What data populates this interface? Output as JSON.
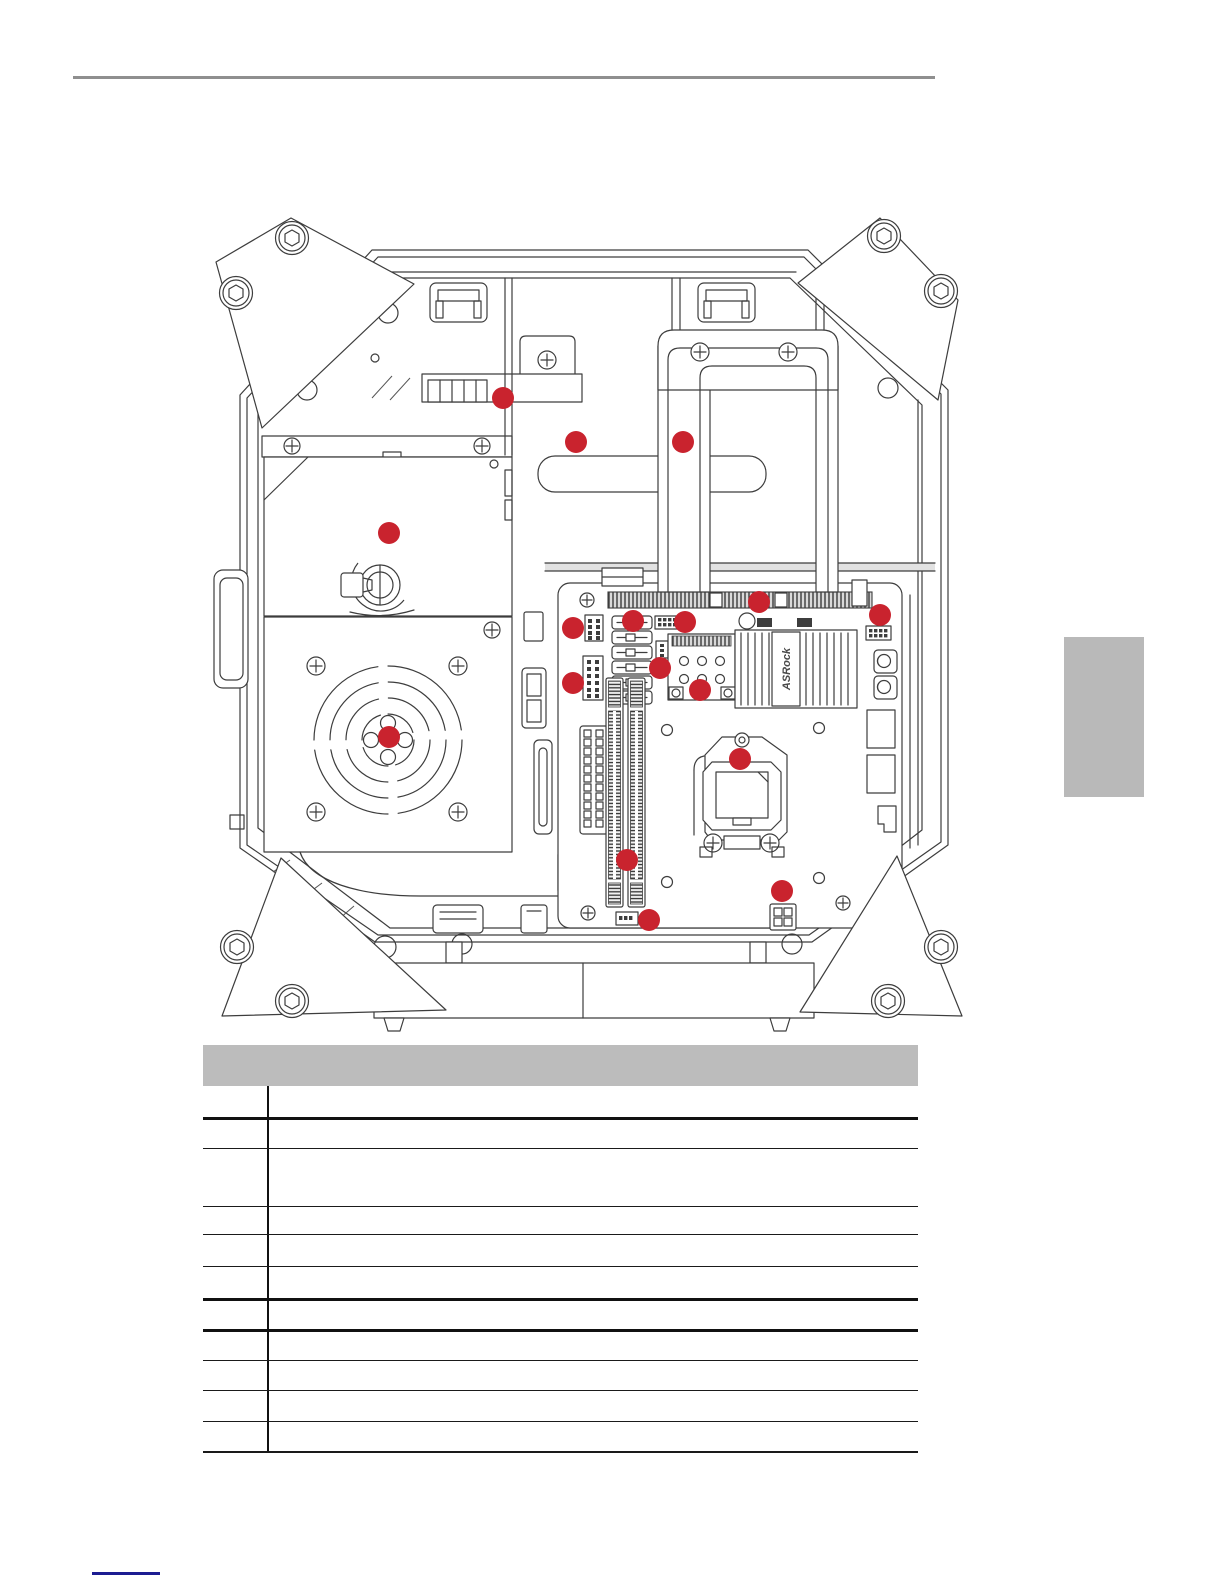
{
  "document": {
    "top_rule_color": "#8f8f8f",
    "footnote_rule_color": "#1c1c92",
    "section_tab_color": "#b9b9b9"
  },
  "illustration": {
    "description": "internal-chassis-component-location-diagram",
    "heatsink_brand": "ASRock",
    "callout": {
      "color": "#c9232e",
      "radius": 11
    },
    "callouts": [
      {
        "x": 503,
        "y": 398
      },
      {
        "x": 576,
        "y": 442
      },
      {
        "x": 683,
        "y": 442
      },
      {
        "x": 389,
        "y": 533
      },
      {
        "x": 759,
        "y": 602
      },
      {
        "x": 880,
        "y": 615
      },
      {
        "x": 573,
        "y": 628
      },
      {
        "x": 633,
        "y": 621
      },
      {
        "x": 685,
        "y": 622
      },
      {
        "x": 660,
        "y": 668
      },
      {
        "x": 573,
        "y": 683
      },
      {
        "x": 700,
        "y": 690
      },
      {
        "x": 389,
        "y": 737
      },
      {
        "x": 740,
        "y": 759
      },
      {
        "x": 627,
        "y": 860
      },
      {
        "x": 782,
        "y": 891
      },
      {
        "x": 649,
        "y": 920
      }
    ]
  },
  "component_table": {
    "header_label": "",
    "rows": [
      {
        "no": "",
        "description": ""
      },
      {
        "no": "",
        "description": ""
      },
      {
        "no": "",
        "description": ""
      },
      {
        "no": "",
        "description": ""
      },
      {
        "no": "",
        "description": ""
      },
      {
        "no": "",
        "description": ""
      },
      {
        "no": "",
        "description": ""
      },
      {
        "no": "",
        "description": ""
      },
      {
        "no": "",
        "description": ""
      },
      {
        "no": "",
        "description": ""
      },
      {
        "no": "",
        "description": ""
      }
    ]
  }
}
